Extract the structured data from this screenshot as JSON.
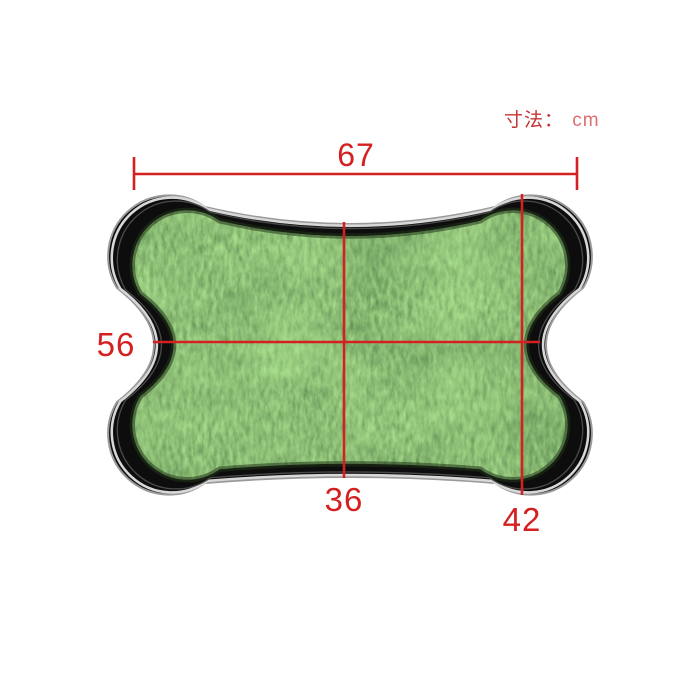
{
  "figure": {
    "type": "product-dimension-diagram",
    "subject": "bone-shaped artificial grass pet pad tray"
  },
  "size_note": {
    "label": "寸法：",
    "unit": "cm"
  },
  "dimensions": {
    "overall_width": {
      "value": "67",
      "orientation": "horizontal",
      "position": "top"
    },
    "inner_width": {
      "value": "56",
      "orientation": "horizontal",
      "position": "middle-left"
    },
    "center_height": {
      "value": "36",
      "orientation": "vertical",
      "position": "bottom-center"
    },
    "end_height": {
      "value": "42",
      "orientation": "vertical",
      "position": "bottom-right"
    }
  },
  "colors": {
    "dimension_red": "#d42020",
    "note_red": "#c43434",
    "unit_red": "#dd6f6f",
    "grass_green": "#4a7f38",
    "grass_edge_dark": "#20351a",
    "tray_black": "#0d0d0d",
    "rim_silver": "#d8d8d8",
    "rim_gray": "#9a9a9a",
    "background": "#ffffff"
  }
}
